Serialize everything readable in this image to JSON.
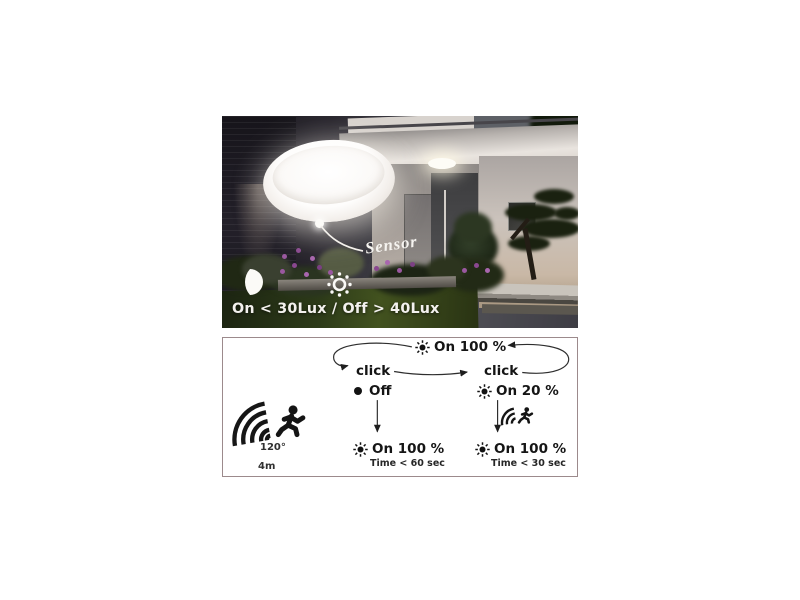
{
  "product_scene": {
    "sensor_callout": "Sensor",
    "lux_rule": "On < 30Lux / Off > 40Lux",
    "icons": {
      "moon-icon": "white crescent moon",
      "daylight-sensor-icon": "white ring sun with dots"
    }
  },
  "mode_diagram": {
    "border_color": "#9c8a8c",
    "text_color": "#151515",
    "top_state": "On 100 %",
    "click_left": "click",
    "click_right": "click",
    "off_state": "Off",
    "dim_state": "On 20 %",
    "motion_left": "On 100 %",
    "motion_left_time": "Time < 60 sec",
    "motion_right": "On 100 %",
    "motion_right_time": "Time < 30 sec",
    "sensor_angle": "120°",
    "sensor_range": "4m",
    "icons": {
      "sun-on-icon": "filled sun with rays",
      "off-dot-icon": "●",
      "motion-sensor-icon": "concentric arcs",
      "running-person-icon": "runner silhouette"
    }
  }
}
